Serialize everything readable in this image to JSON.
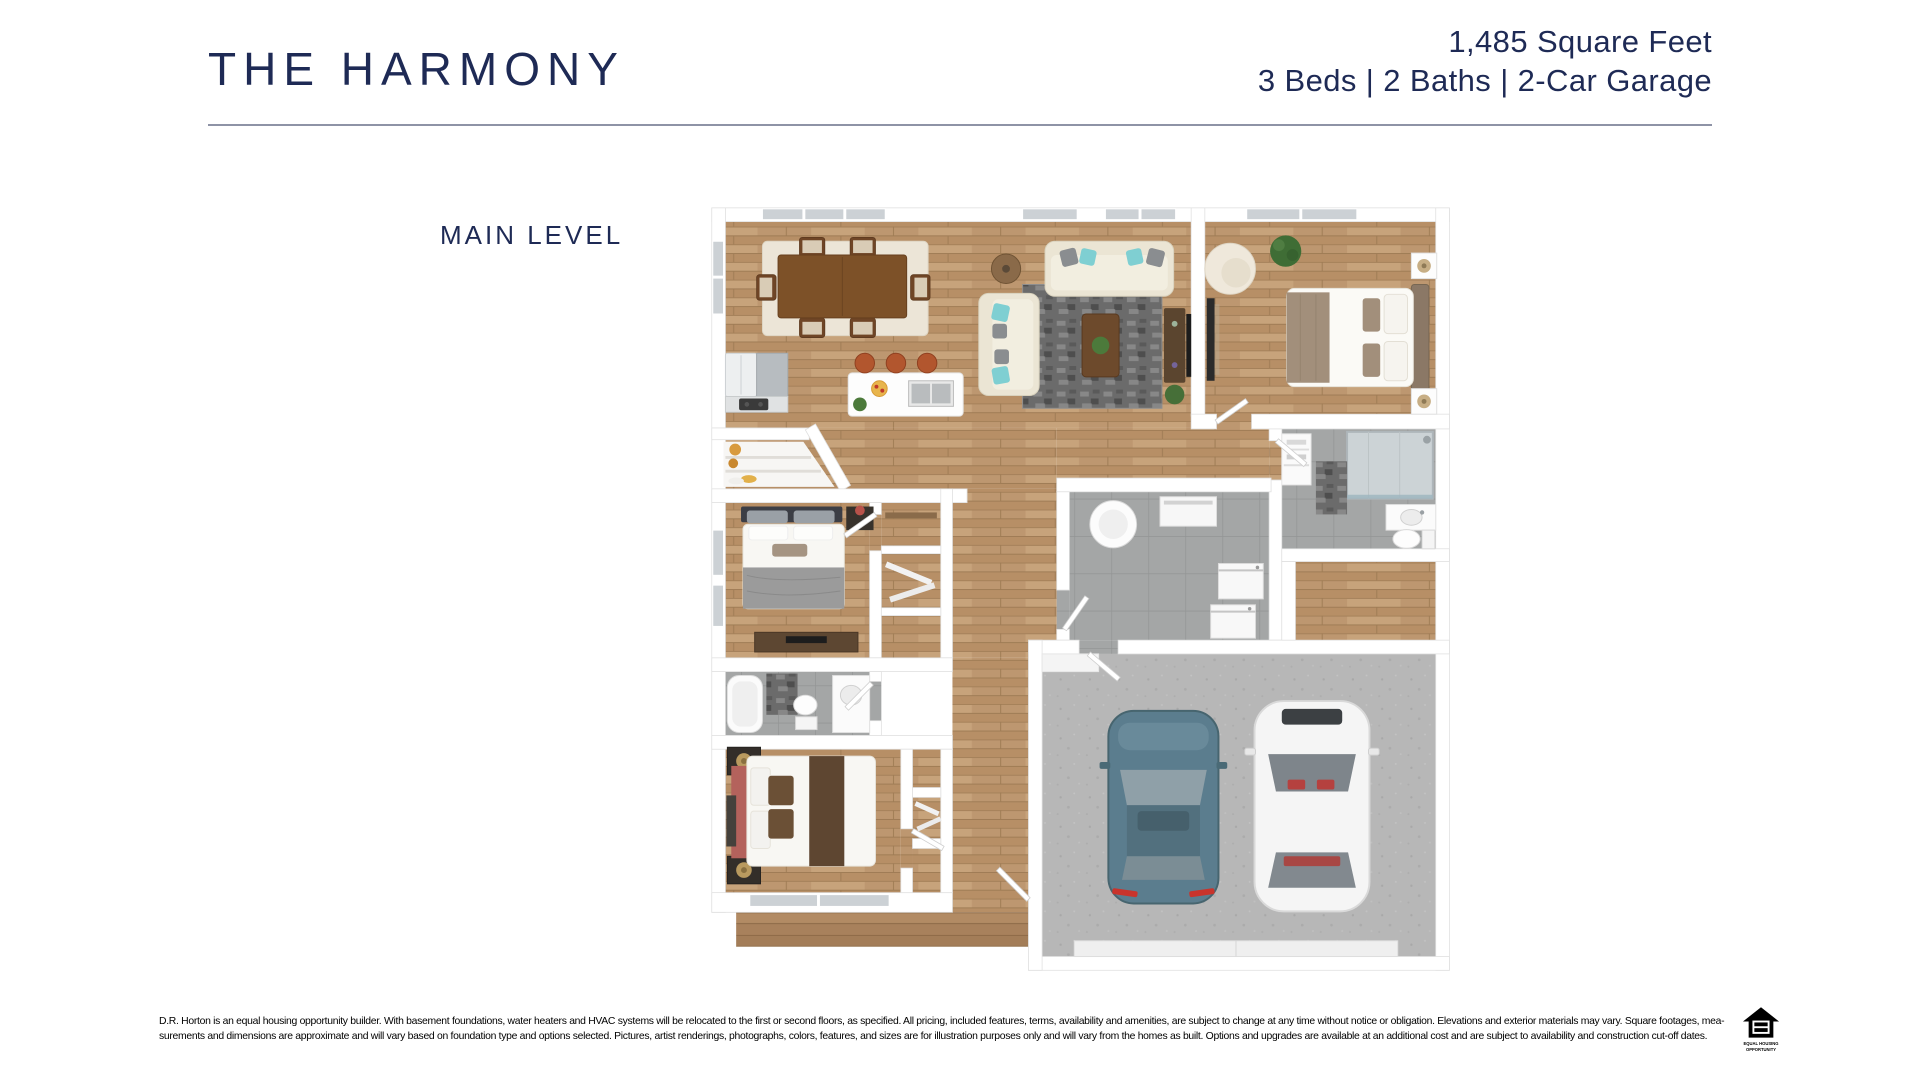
{
  "header": {
    "title": "THE HARMONY",
    "spec_line1": "1,485 Square Feet",
    "spec_line2": "3 Beds | 2 Baths | 2-Car Garage"
  },
  "plan": {
    "level_label": "MAIN LEVEL",
    "type": "3d-top-down-floorplan",
    "rooms_depicted": "open great room with dining set and kitchen island, primary bedroom, two secondary bedrooms, two bathrooms, laundry room, walk-in closet, entry porch, attached 2-car garage with two cars"
  },
  "footer": {
    "disclaimer_line1": "D.R. Horton is an equal housing opportunity builder. With basement foundations, water heaters and HVAC systems will be relocated to the first or second floors, as specified. All pricing, included features, terms, availability and amenities, are subject to change at any time without notice or obligation. Elevations and exterior materials may vary. Square footages, mea-",
    "disclaimer_line2": "surements and dimensions are approximate and will vary based on foundation type and options selected. Pictures, artist renderings, photographs, colors, features, and sizes are for illustration purposes only and will vary from the homes as built. Options and upgrades are available at an additional cost and are subject to availability and construction cut-off dates.",
    "eho_line1": "EQUAL HOUSING",
    "eho_line2": "OPPORTUNITY"
  },
  "colors": {
    "brand_navy": "#1e2a55",
    "rule_gray": "#8e93a6",
    "wood_floor": "#c19b72",
    "tile_gray": "#a4a6a6",
    "garage_concrete": "#b7b7b7",
    "car_blue": "#5b7d8e",
    "car_white": "#f5f5f5",
    "sofa_cream": "#ebe5d4",
    "accent_teal": "#7fcfd2"
  }
}
